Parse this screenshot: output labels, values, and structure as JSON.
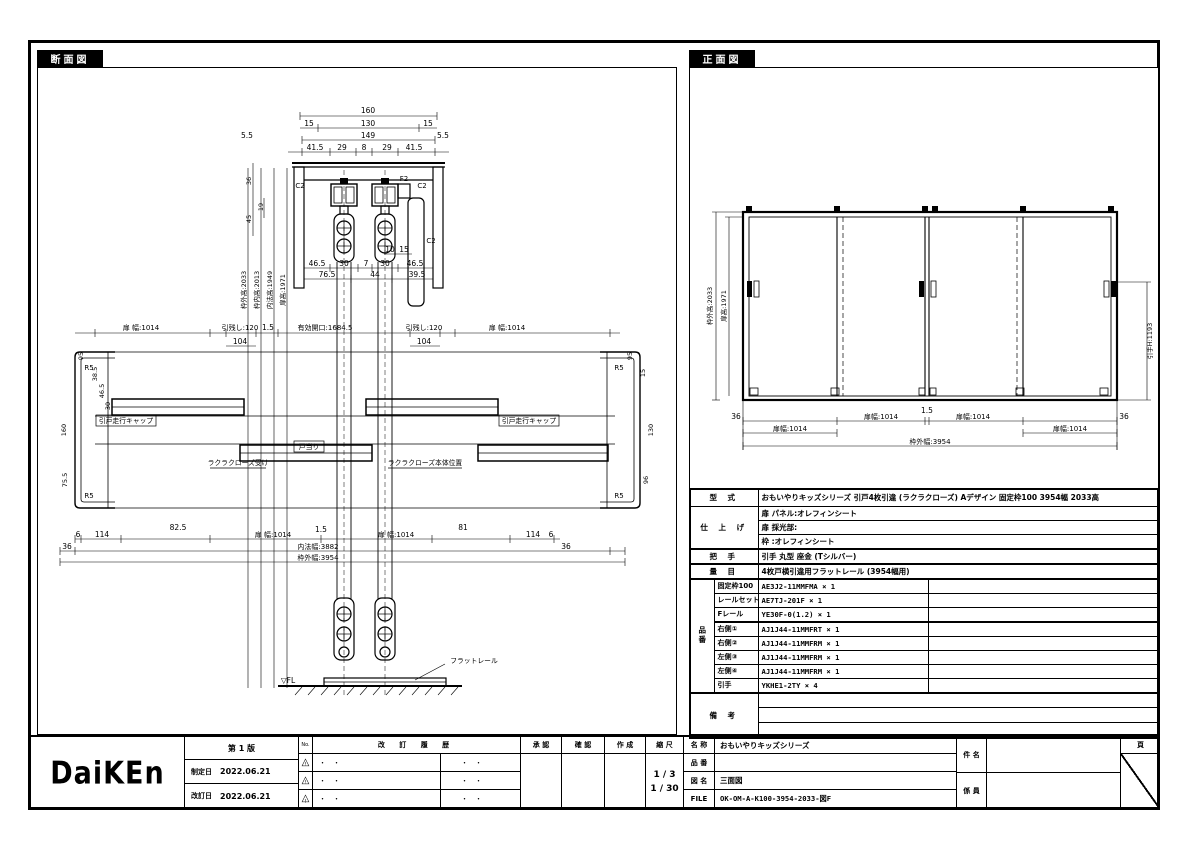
{
  "section": {
    "title": "断面図",
    "head_top": [
      "160",
      "15",
      "130",
      "15",
      "149",
      "5.5",
      "5.5",
      "41.5",
      "29",
      "8",
      "29",
      "41.5"
    ],
    "head_left": [
      "36",
      "19",
      "45"
    ],
    "head_bottom": [
      "46.5",
      "30",
      "7",
      "30",
      "46.5",
      "76.5",
      "44",
      "39.5"
    ],
    "head_marks": [
      "C2",
      "C2",
      "C2",
      "F2",
      "10",
      "15"
    ],
    "heights": [
      "枠外高:2033",
      "枠内高:2013",
      "内法高:1949",
      "扉高:1971"
    ],
    "mid_top": [
      "扉 幅:1014",
      "引残し:120",
      "104",
      "1.5",
      "有効開口:1684.5",
      "引残し:120",
      "104",
      "扉 幅:1014"
    ],
    "jamb_left": [
      "R5",
      "R5",
      "95",
      "38.5",
      "46.5",
      "30",
      "160",
      "75.5"
    ],
    "jamb_right": [
      "R5",
      "R5",
      "95",
      "15",
      "130",
      "96"
    ],
    "mid_bottom": [
      "6",
      "114",
      "82.5",
      "扉 幅:1014",
      "1.5",
      "扉 幅:1014",
      "81",
      "114",
      "6",
      "36",
      "36",
      "内法幅:3882",
      "枠外幅:3954"
    ],
    "callouts": [
      "引戸走行キャップ",
      "戸当り",
      "引戸走行キャップ",
      "ラクラクローズ受け",
      "ラクラクローズ本体位置",
      "フラットレール"
    ],
    "fl_mark": "▽FL"
  },
  "front": {
    "title": "正面図",
    "heights": [
      "枠外高:2033",
      "扉高:1971"
    ],
    "handle_height": "引手H:1193",
    "bottom": [
      "36",
      "扉幅:1014",
      "1.5",
      "扉幅:1014",
      "扉幅:1014",
      "扉幅:1014",
      "36",
      "枠外幅:3954"
    ]
  },
  "spec": {
    "model_label": "型  式",
    "model": "おもいやりキッズシリーズ 引戸4枚引違 (ラクラクローズ)  Aデザイン  固定枠100 3954幅 2033高",
    "finish_label": "仕 上 げ",
    "finish_rows": [
      "扉 パネル:オレフィンシート",
      "扉 採光部:",
      "枠      :オレフィンシート"
    ],
    "handle_label": "把  手",
    "handle": "引手 丸型 座金 (Tシルバー)",
    "qty_label": "量  目",
    "qty": "4枚戸横引違用フラットレール (3954幅用)",
    "parts_label": "品番",
    "parts": [
      {
        "name": "固定枠100",
        "code": "AE3J2-11MMFMA × 1"
      },
      {
        "name": "レールセット",
        "code": "AE7TJ-201F × 1"
      },
      {
        "name": "Fレール",
        "code": "YE30F-0(1.2) × 1"
      },
      {
        "name": "右側①",
        "code": "AJ1J44-11MMFRT × 1"
      },
      {
        "name": "右側②",
        "code": "AJ1J44-11MMFRM × 1"
      },
      {
        "name": "左側③",
        "code": "AJ1J44-11MMFRM × 1"
      },
      {
        "name": "左側④",
        "code": "AJ1J44-11MMFRM × 1"
      },
      {
        "name": "引手",
        "code": "YKHE1-2TY × 4"
      }
    ],
    "remarks_label": "備  考"
  },
  "titleblock": {
    "logo": "DaiKEn",
    "edition": "第 1 版",
    "enacted_label": "制定日",
    "enacted_date": "2022.06.21",
    "revised_label": "改訂日",
    "revised_date": "2022.06.21",
    "no_label": "No.",
    "history_label": "改 訂 履 歴",
    "dot_placeholder": "・　・",
    "warning_mark": "△",
    "warning_excl": "!",
    "approval_label": "承 認",
    "check_label": "確 認",
    "create_label": "作 成",
    "scale_label": "縮 尺",
    "scale_1": "1 / 3",
    "scale_2": "1 / 30",
    "name_label": "名 称",
    "name_value": "おもいやりキッズシリーズ",
    "part_label": "品 番",
    "part_value": "",
    "drawing_label": "図 名",
    "drawing_value": "三面図",
    "file_label": "FILE",
    "file_value": "OK-OM-A-K100-3954-2033-図F",
    "subject_label": "件 名",
    "staff_label": "係 員",
    "page_label": "頁"
  }
}
